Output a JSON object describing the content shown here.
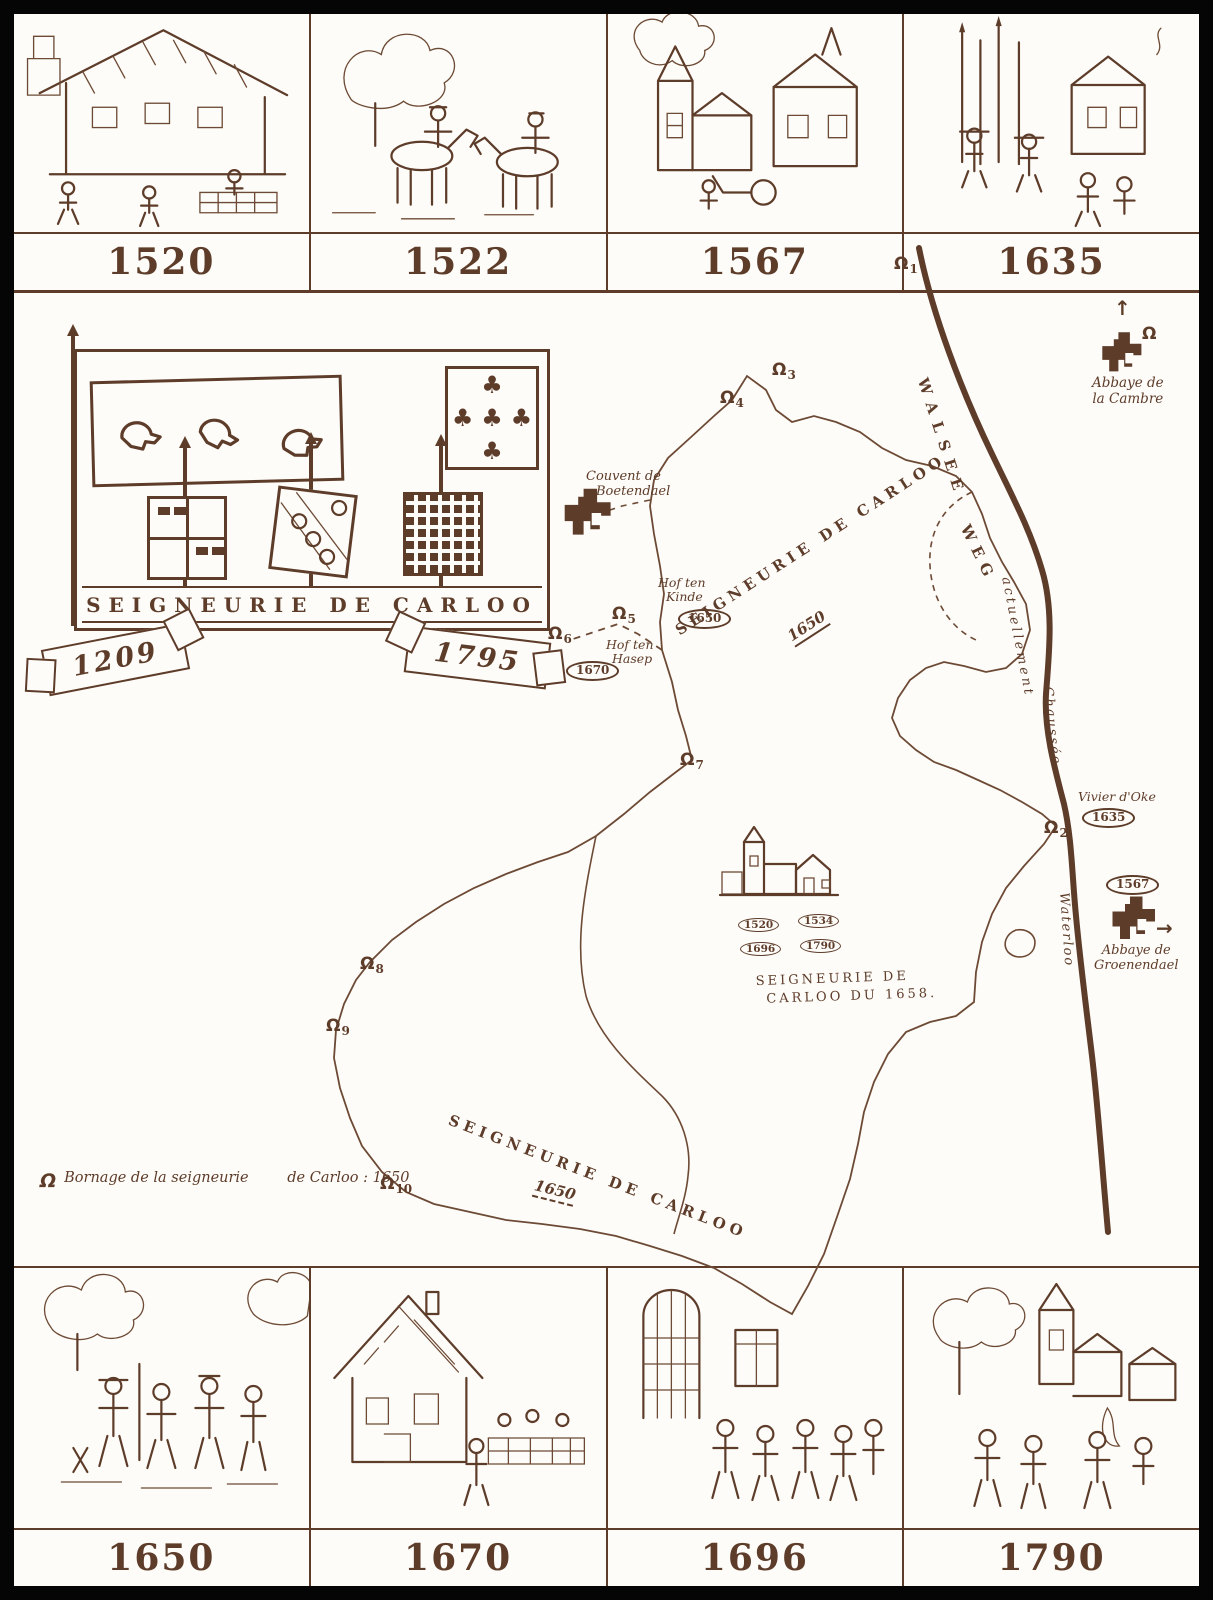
{
  "palette": {
    "ink": "#5e3c2a",
    "paper": "#fdfcf8",
    "frame": "#050505"
  },
  "icons": {
    "boundary_marker": "Ω",
    "arrow_up": "↑",
    "arrow_right": "→",
    "trefoil": "♣"
  },
  "top_vignettes": [
    {
      "year": "1520",
      "scene": "village-inn-and-masons"
    },
    {
      "year": "1522",
      "scene": "two-horsemen-meeting"
    },
    {
      "year": "1567",
      "scene": "church-houses-and-cart"
    },
    {
      "year": "1635",
      "scene": "soldiers-with-pikes"
    }
  ],
  "bottom_vignettes": [
    {
      "year": "1650",
      "scene": "boundary-survey-group"
    },
    {
      "year": "1670",
      "scene": "farmhouse-and-market-wall"
    },
    {
      "year": "1696",
      "scene": "procession-before-church-window"
    },
    {
      "year": "1790",
      "scene": "village-church-and-crowd"
    }
  ],
  "heraldic_panel": {
    "title": "SEIGNEURIE DE CARLOO"
  },
  "ribbons": {
    "left": "1209",
    "right": "1795"
  },
  "map": {
    "labels": {
      "couvent": {
        "line1": "Couvent de",
        "line2": "Boetendael"
      },
      "abbaye_cambre": {
        "line1": "Abbaye de",
        "line2": "la Cambre"
      },
      "abbaye_groenendael": {
        "line1": "Abbaye de",
        "line2": "Groenendael",
        "year": "1567"
      },
      "hof_ten_kinde": {
        "line1": "Hof ten",
        "line2": "Kinde",
        "year": "1650"
      },
      "hof_ten_hasep": {
        "line1": "Hof ten",
        "line2": "Hasep",
        "year": "1670"
      },
      "vivier_oke": {
        "name": "Vivier d'Oke",
        "year": "1635"
      },
      "seigneurie_1650_north": {
        "name": "SEIGNEURIE DE CARLOO",
        "year": "1650"
      },
      "seigneurie_1650_south": {
        "name": "SEIGNEURIE DE CARLOO",
        "year": "1650"
      },
      "seigneurie_1658": {
        "line1": "SEIGNEURIE DE",
        "line2": "CARLOO DU 1658."
      },
      "hamlet_years": [
        "1520",
        "1534",
        "1696",
        "1790"
      ]
    },
    "road_labels": {
      "walsee": "WALSEE",
      "weg": "WEG",
      "actuellement": "actuellement",
      "chaussee": "Chaussée",
      "waterloo": "Waterloo"
    },
    "markers": [
      {
        "n": "1"
      },
      {
        "n": "2"
      },
      {
        "n": "3"
      },
      {
        "n": "4"
      },
      {
        "n": "5"
      },
      {
        "n": "6"
      },
      {
        "n": "7"
      },
      {
        "n": "8"
      },
      {
        "n": "9"
      },
      {
        "n": "10"
      }
    ],
    "legend": {
      "line1": "Bornage de la seigneurie",
      "line2": "de Carloo : 1650"
    }
  }
}
